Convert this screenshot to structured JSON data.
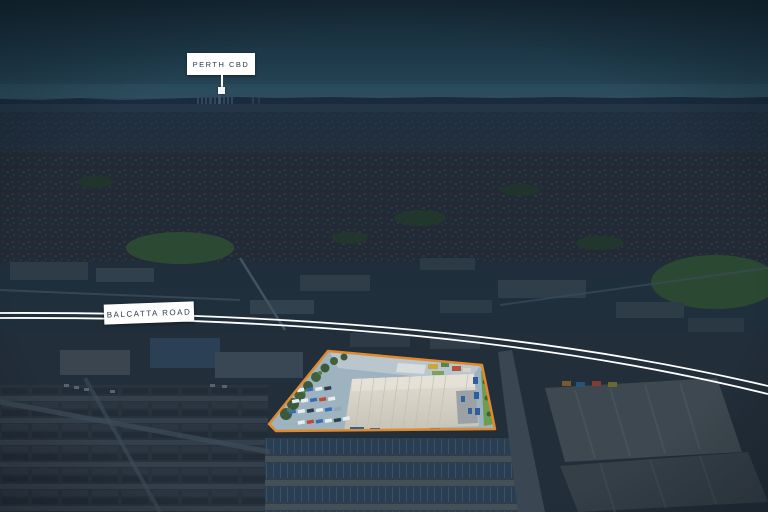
{
  "annotations": {
    "cbd_callout": {
      "label": "PERTH CBD"
    },
    "road_callout": {
      "label": "BALCATTA ROAD"
    }
  },
  "highlight": {
    "outline_color": "#E1892D"
  },
  "colors": {
    "road_line": "#FFFFFF",
    "callout_bg": "#FFFFFF",
    "callout_text": "#2B3B4A",
    "marker": "#F4F7F9",
    "sky_top": "#152733",
    "night_tint": "#1C2C3C",
    "carpark": "#9DB3C0",
    "warehouse_roof": "#D9D5CA",
    "landscape_strip": "#6F9C52"
  }
}
